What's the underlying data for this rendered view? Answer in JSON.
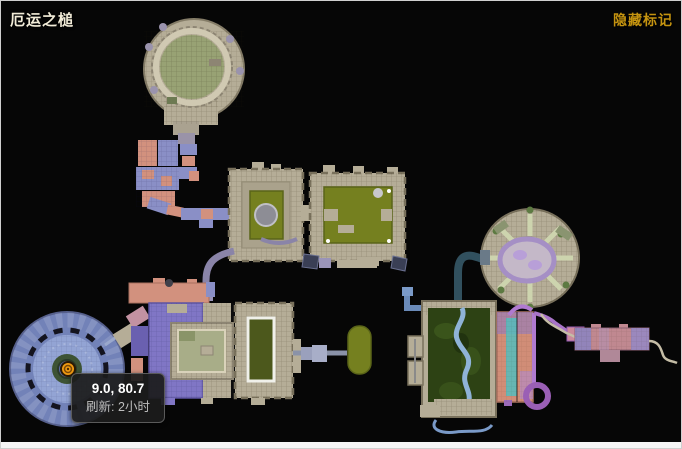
{
  "window": {
    "map_title": "厄运之槌",
    "hide_markers_label": "隐藏标记"
  },
  "tooltip": {
    "coordinates": "9.0, 80.7",
    "refresh": "刷新: 2小时"
  },
  "marker": {
    "icon": "orange-boss-marker-icon",
    "coordinates": "9.0, 80.7"
  },
  "map": {
    "regions": [
      "north-arena",
      "west-chain",
      "central-west-hall",
      "central-east-hall",
      "east-arena",
      "southwest-plaza",
      "southwest-halls",
      "south-capsule",
      "southeast-gardens",
      "southeast-annex",
      "east-corridor"
    ]
  },
  "colors": {
    "background": "#060606",
    "title": "#f2ecd8",
    "hide_markers": "#c49310",
    "tooltip_bg": "#1c1c1c",
    "tooltip_border": "#5a5a5a",
    "tooltip_text_primary": "#ffffff",
    "tooltip_text_secondary": "#bdbdbd",
    "stone": "#b5ad97",
    "courtyard_green": "#75801f",
    "garden_green": "#2d4214",
    "plaza_blue": "#7282b8",
    "room_purple": "#8076c5",
    "room_pink": "#d2917e",
    "river_blue": "#8fb3d8",
    "loop_purple": "#9a5fb5",
    "marker_orange": "#f09a12"
  }
}
